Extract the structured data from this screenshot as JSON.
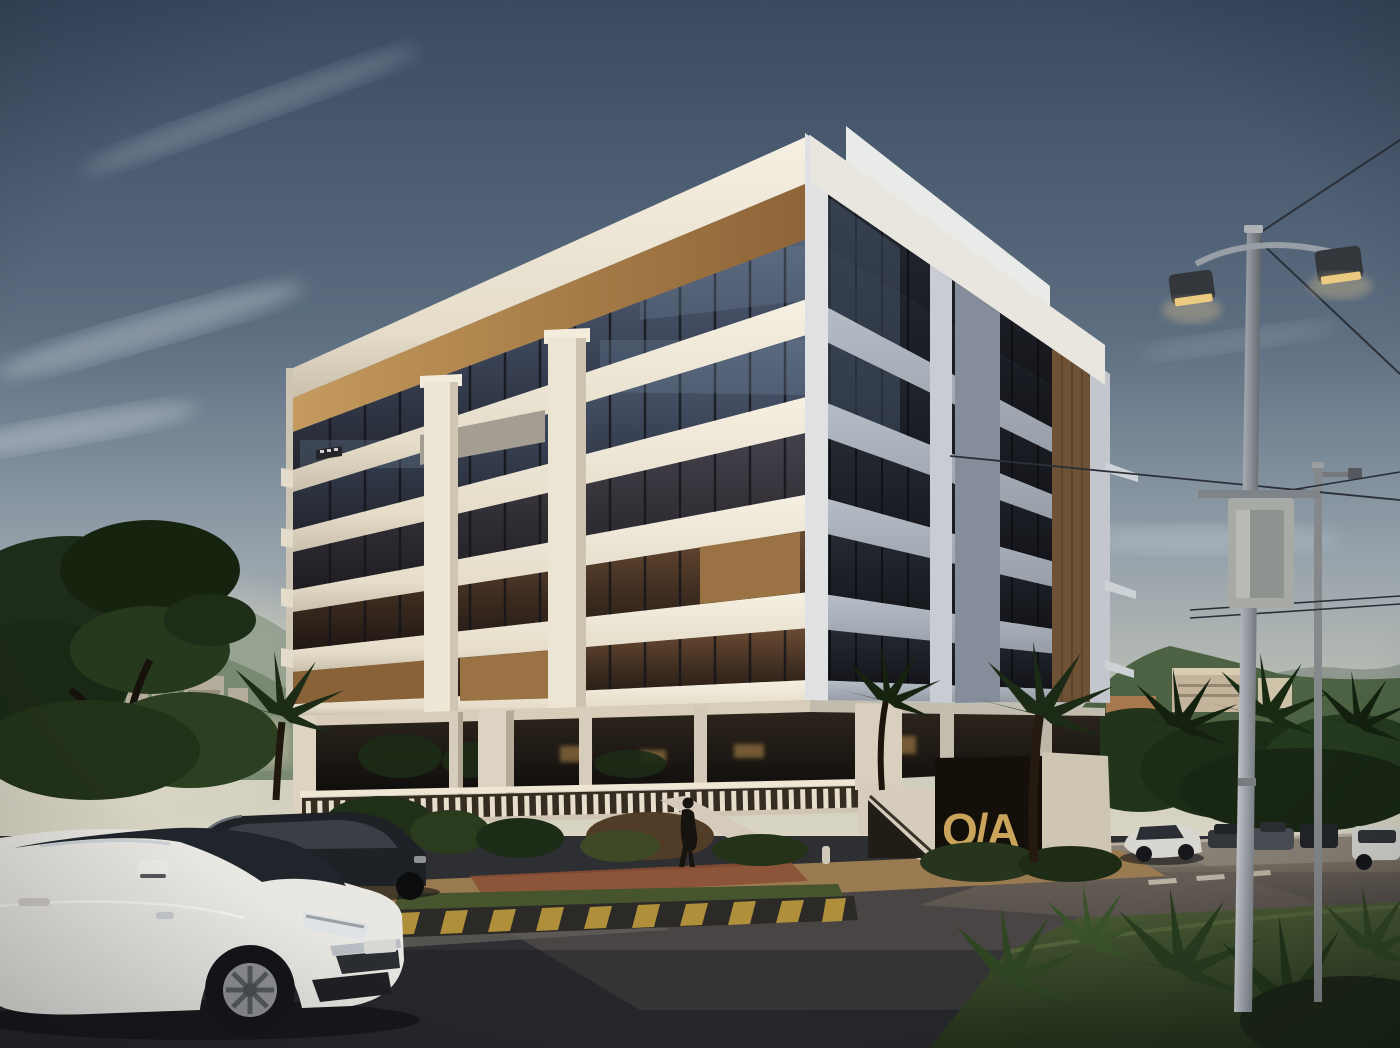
{
  "meta": {
    "description": "Photorealistic dusk rendering of a modern six-storey corner building on pilotis with white concrete bands, dark tinted glazing and wood cladding accents, at a street intersection with parked cars, a pedestrian, street lighting, palm trees, city towers and mountains in the background.",
    "time_of_day": "dusk",
    "width_px": 1400,
    "height_px": 1048
  },
  "signage": {
    "entrance_letters": "O/A"
  },
  "building": {
    "storeys_visible": 6,
    "ground_level": "open pilotis with columns, terrace balustrade, ramp and stairs",
    "materials": [
      "white concrete horizontal bands",
      "dark tinted glass",
      "oak wood cladding"
    ],
    "accent_logo_color": "#c9a45a"
  },
  "objects": [
    "white sedan foreground",
    "dark minivan",
    "white sedan right street",
    "parked cars background",
    "white suv far right",
    "pedestrian",
    "double-arm street light",
    "utility pole with sign box",
    "overhead wires",
    "median island with hazard-striped curb",
    "grass verge with agave plants",
    "palm trees",
    "large tree left",
    "city towers",
    "mountain ridges"
  ],
  "colors": {
    "sky_top": "#3a4960",
    "sky_mid": "#5d6e81",
    "sky_low": "#93a0aa",
    "horizon_haze": "#e3dcc8",
    "cloud": "#e8ecf2",
    "mountain_far_left": "#93a08e",
    "mountain_near_left": "#77866e",
    "mountain_right": "#4c6243",
    "mountain_right_far": "#8a9589",
    "city_silhouette": "#b5ad9c",
    "foliage_dark": "#1c2b17",
    "foliage_mid": "#2c4021",
    "grass_verge": "#3b4a2b",
    "median_grass": "#47552f",
    "facade_white_lit": "#f2ecdd",
    "facade_white_shadow": "#aab1ba",
    "fascia": "#f3eee0",
    "wood_light": "#b68c54",
    "wood_dark": "#6f5236",
    "glass_cool": "#3d4759",
    "glass_warm": "#5a4130",
    "glass_dark": "#191b20",
    "gold_accent": "#c9a45a",
    "ceiling_warm": "#d8cdb8",
    "recess_dark": "#171310",
    "sidewalk": "#9a7a50",
    "paver_red": "#8a4e34",
    "road_dark": "#2e2f33",
    "road_warm": "#6b6158",
    "road_light": "#8a8176",
    "curb_yellow": "#bf9a3e",
    "curb_dark": "#2c2a26",
    "car_white": "#e9e7e2",
    "car_dark": "#22252a",
    "pole_gray": "#9aa0a6",
    "lamp_glow": "#eac87e",
    "wire": "#2a2f38"
  }
}
